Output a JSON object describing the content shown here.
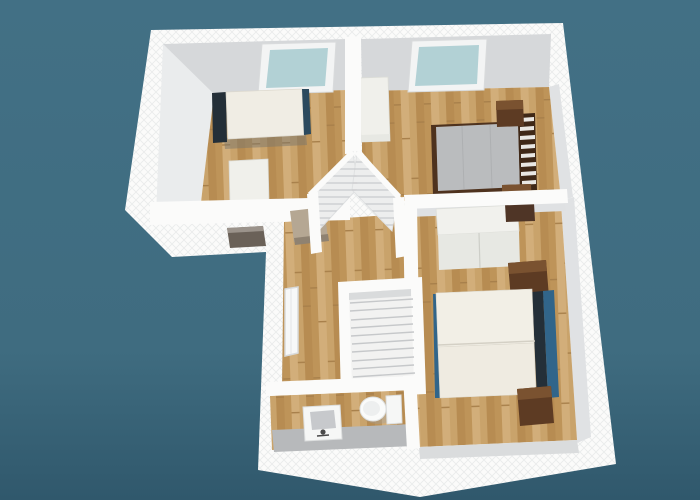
{
  "scene": {
    "kind": "3d-floorplan-dollhouse-render",
    "view": "aerial perspective of an upper floor, no visible text or UI chrome",
    "rooms": [
      {
        "name": "bedroom-top-left"
      },
      {
        "name": "bedroom-top-right"
      },
      {
        "name": "bedroom-bottom-right"
      },
      {
        "name": "hallway-landing"
      },
      {
        "name": "bathroom"
      }
    ],
    "objects": [
      {
        "name": "skylight-left",
        "kind": "roof-window"
      },
      {
        "name": "skylight-right",
        "kind": "roof-window"
      },
      {
        "name": "single-bed",
        "kind": "bed"
      },
      {
        "name": "desk-left-room",
        "kind": "table"
      },
      {
        "name": "south-wall-window",
        "kind": "window"
      },
      {
        "name": "double-bed-gray",
        "kind": "bed"
      },
      {
        "name": "nightstand",
        "kind": "nightstand",
        "count": 4
      },
      {
        "name": "wardrobe-top-right-room",
        "kind": "wardrobe"
      },
      {
        "name": "wardrobe-bottom-room",
        "kind": "wardrobe"
      },
      {
        "name": "double-bed-white",
        "kind": "bed"
      },
      {
        "name": "louvered-corner-closet",
        "kind": "closet"
      },
      {
        "name": "staircase",
        "kind": "stairs"
      },
      {
        "name": "hall-west-window",
        "kind": "window"
      },
      {
        "name": "closet-shelf",
        "kind": "shelf"
      },
      {
        "name": "bathroom-sink",
        "kind": "sink"
      },
      {
        "name": "toilet",
        "kind": "toilet"
      }
    ]
  },
  "colors": {
    "bgTop": "#427085",
    "bgMid": "#3F6C80",
    "bgBottom": "#30586C",
    "wallWhite": "#FBFBFA",
    "wallHatch": "#E9EBEB",
    "wallFace": "#D6D8DA",
    "wallFaceLight": "#EAECED",
    "wallFaceMid": "#E0E2E4",
    "wallFaceDim": "#DADCDD",
    "wood1": "#C9A36B",
    "wood2": "#BE9459",
    "wood3": "#D2AE7A",
    "wood4": "#B78C52",
    "woodLine": "#A8804B",
    "skylightGlass": "#B2D1D5",
    "skylightFrame": "#F3F4F4",
    "cream": "#F0EDE4",
    "creamDim": "#EFEBE1",
    "navy": "#242F38",
    "steelBlue": "#31658A",
    "grayMattress": "#BABCBE",
    "darkWood": "#5D3B23",
    "darkWoodLight": "#7A5230",
    "darkWoodDeep": "#3F2817",
    "furnWhite": "#F0F0EB",
    "furnWhiteDim": "#E7E8E3",
    "grayFloor": "#B7B9BB",
    "stairTread": "#F2F2F1",
    "stairLine": "#C6C8CA",
    "fixtureWhite": "#F6F7F6",
    "basinGray": "#C7C9CC",
    "tanShelf": "#B5A793",
    "tanShelfDark": "#8F8271",
    "glassDark": "#6A6158",
    "metalGray": "#4A4A4A",
    "shadow": "#7A756C"
  }
}
